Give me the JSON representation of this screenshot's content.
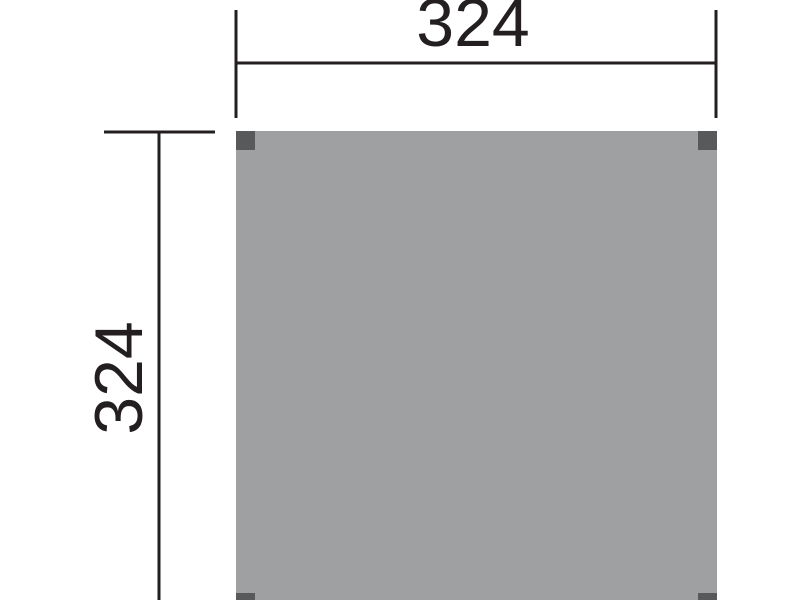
{
  "colors": {
    "background": "#ffffff",
    "line": "#231f20",
    "panel_fill": "#9fa0a2",
    "post_fill": "#58595b"
  },
  "dimensions": {
    "top": {
      "label": "324"
    },
    "left": {
      "label": "324"
    }
  }
}
